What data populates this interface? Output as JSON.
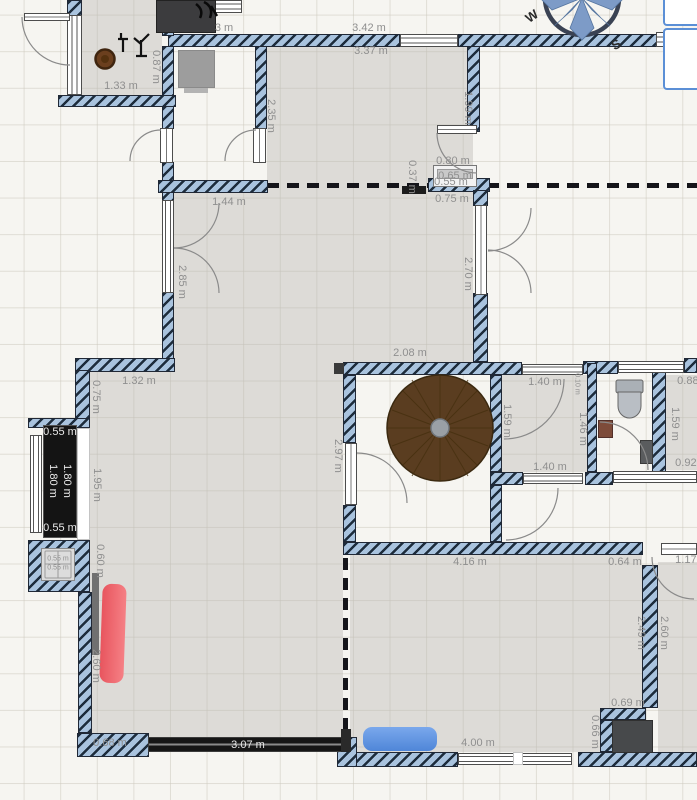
{
  "app": {
    "view": "floor-plan-canvas"
  },
  "canvas": {
    "width": 697,
    "height": 800
  },
  "compass": {
    "west_label": "W",
    "south_label": "S"
  },
  "side_panel": {
    "icon": "arrow-down-right-icon"
  },
  "colors": {
    "wall_fill": "#a9c3de",
    "wall_hatch": "#1d2c3c",
    "room_fill": "rgba(186,184,179,0.42)",
    "dimension_text": "#8f8f8f",
    "sofa_red": "#ee5d64",
    "sofa_blue": "#5f96e8",
    "table_brown": "#5a3d20",
    "counter_black": "#141414",
    "panel_border": "#5b8fd6"
  },
  "dimension_labels": [
    {
      "text": "1.33 m",
      "x": 121,
      "y": 86,
      "rotate": 0,
      "variant": "default"
    },
    {
      "text": "0.87 m",
      "x": 156,
      "y": 67,
      "rotate": 90,
      "variant": "default"
    },
    {
      "text": "3 m",
      "x": 224,
      "y": 28,
      "rotate": 0,
      "variant": "default"
    },
    {
      "text": "3.42 m",
      "x": 369,
      "y": 28,
      "rotate": 0,
      "variant": "default"
    },
    {
      "text": "3.37 m",
      "x": 371,
      "y": 51,
      "rotate": 0,
      "variant": "default"
    },
    {
      "text": "2.35 m",
      "x": 271,
      "y": 116,
      "rotate": 90,
      "variant": "default"
    },
    {
      "text": "1.99 m",
      "x": 468,
      "y": 108,
      "rotate": 90,
      "variant": "default"
    },
    {
      "text": "0.80 m",
      "x": 453,
      "y": 161,
      "rotate": 0,
      "variant": "default"
    },
    {
      "text": "0.65 m",
      "x": 455,
      "y": 176,
      "rotate": 0,
      "variant": "default"
    },
    {
      "text": "0.55 m",
      "x": 451,
      "y": 182,
      "rotate": 0,
      "variant": "default"
    },
    {
      "text": "0.37 m",
      "x": 412,
      "y": 177,
      "rotate": 90,
      "variant": "default"
    },
    {
      "text": "0.75 m",
      "x": 452,
      "y": 199,
      "rotate": 0,
      "variant": "default"
    },
    {
      "text": "1.44 m",
      "x": 229,
      "y": 202,
      "rotate": 0,
      "variant": "default"
    },
    {
      "text": "2.85 m",
      "x": 182,
      "y": 282,
      "rotate": 90,
      "variant": "default"
    },
    {
      "text": "2.70 m",
      "x": 468,
      "y": 274,
      "rotate": 90,
      "variant": "default"
    },
    {
      "text": "2.08 m",
      "x": 410,
      "y": 353,
      "rotate": 0,
      "variant": "default"
    },
    {
      "text": "1.32 m",
      "x": 139,
      "y": 381,
      "rotate": 0,
      "variant": "default"
    },
    {
      "text": "0.75 m",
      "x": 96,
      "y": 397,
      "rotate": 90,
      "variant": "default"
    },
    {
      "text": "1.95 m",
      "x": 97,
      "y": 485,
      "rotate": 90,
      "variant": "default"
    },
    {
      "text": "0.60 m",
      "x": 100,
      "y": 561,
      "rotate": 90,
      "variant": "default"
    },
    {
      "text": "2.97 m",
      "x": 338,
      "y": 456,
      "rotate": 90,
      "variant": "default"
    },
    {
      "text": "1.40 m",
      "x": 545,
      "y": 382,
      "rotate": 0,
      "variant": "default"
    },
    {
      "text": "1.59 m",
      "x": 507,
      "y": 421,
      "rotate": 90,
      "variant": "default"
    },
    {
      "text": "1.46 m",
      "x": 583,
      "y": 429,
      "rotate": 90,
      "variant": "default"
    },
    {
      "text": "1.40 m",
      "x": 550,
      "y": 467,
      "rotate": 0,
      "variant": "default"
    },
    {
      "text": "0.10 m",
      "x": 577,
      "y": 384,
      "rotate": 90,
      "variant": "tiny"
    },
    {
      "text": "0.88 m",
      "x": 694,
      "y": 381,
      "rotate": 0,
      "variant": "default"
    },
    {
      "text": "1.59 m",
      "x": 675,
      "y": 424,
      "rotate": 90,
      "variant": "default"
    },
    {
      "text": "0.92 m",
      "x": 692,
      "y": 463,
      "rotate": 0,
      "variant": "default"
    },
    {
      "text": "4.16 m",
      "x": 470,
      "y": 562,
      "rotate": 0,
      "variant": "default"
    },
    {
      "text": "0.64 m",
      "x": 625,
      "y": 562,
      "rotate": 0,
      "variant": "default"
    },
    {
      "text": "1.17 m",
      "x": 692,
      "y": 560,
      "rotate": 0,
      "variant": "default"
    },
    {
      "text": "2.49 m",
      "x": 641,
      "y": 633,
      "rotate": 90,
      "variant": "default"
    },
    {
      "text": "2.60 m",
      "x": 664,
      "y": 633,
      "rotate": 90,
      "variant": "default"
    },
    {
      "text": "0.69 m",
      "x": 628,
      "y": 703,
      "rotate": 0,
      "variant": "default"
    },
    {
      "text": "0.66 m",
      "x": 595,
      "y": 732,
      "rotate": 90,
      "variant": "default"
    },
    {
      "text": "4.00 m",
      "x": 478,
      "y": 743,
      "rotate": 0,
      "variant": "default"
    },
    {
      "text": "2.60 m",
      "x": 96,
      "y": 666,
      "rotate": 90,
      "variant": "default"
    },
    {
      "text": "0.68 m",
      "x": 110,
      "y": 743,
      "rotate": 0,
      "variant": "default"
    },
    {
      "text": "3.07 m",
      "x": 248,
      "y": 745,
      "rotate": 0,
      "variant": "white"
    },
    {
      "text": "0.55 m",
      "x": 60,
      "y": 432,
      "rotate": 0,
      "variant": "white"
    },
    {
      "text": "1.80 m",
      "x": 53,
      "y": 481,
      "rotate": 90,
      "variant": "white"
    },
    {
      "text": "1.80 m",
      "x": 67,
      "y": 481,
      "rotate": 90,
      "variant": "white"
    },
    {
      "text": "0.55 m",
      "x": 60,
      "y": 528,
      "rotate": 0,
      "variant": "white"
    },
    {
      "text": "0.55 m",
      "x": 58,
      "y": 559,
      "rotate": 0,
      "variant": "tiny"
    },
    {
      "text": "0.55 m",
      "x": 58,
      "y": 568,
      "rotate": 0,
      "variant": "tiny"
    }
  ]
}
